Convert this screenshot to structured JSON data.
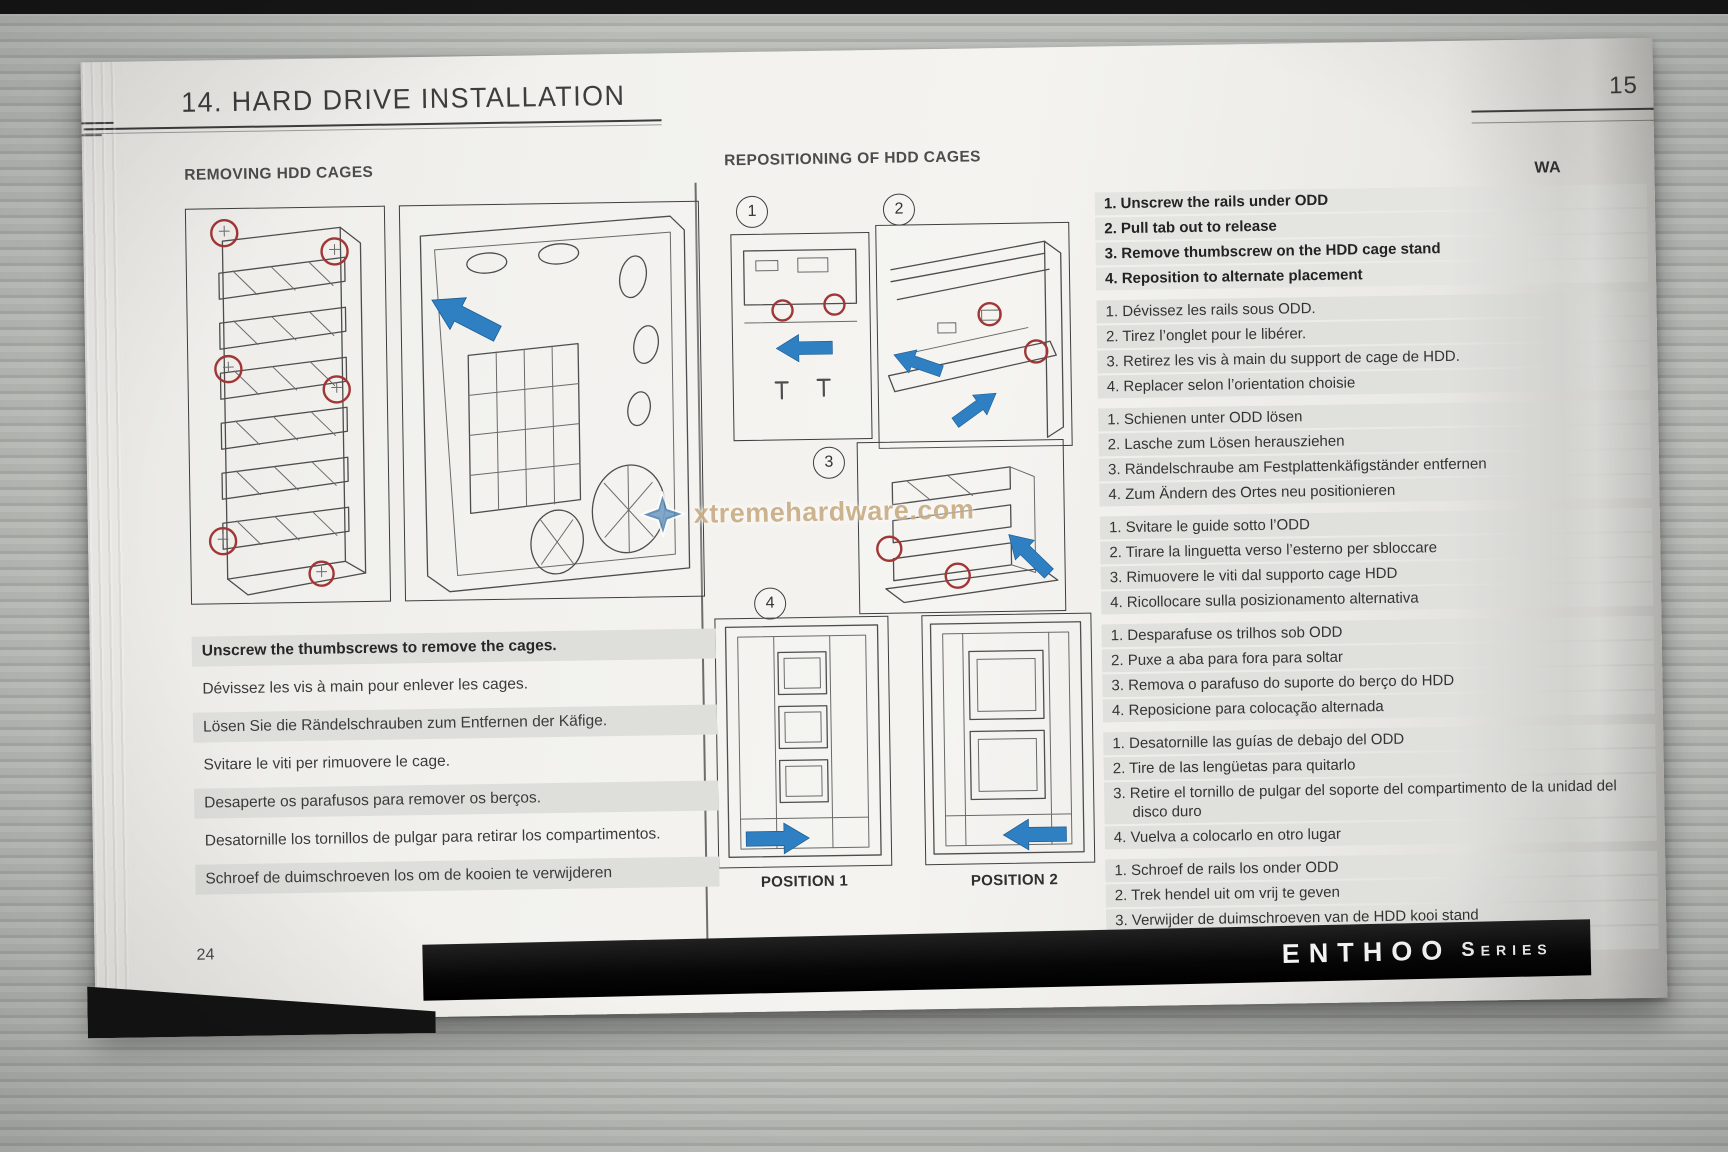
{
  "photo": {
    "background_color": "#b3b5b1",
    "accent_blue": "#2f80c3",
    "accent_red": "#a03636"
  },
  "header": {
    "title": "14. HARD DRIVE INSTALLATION",
    "next_page_number": "15",
    "next_page_partial_heading": "WA"
  },
  "watermark": {
    "text": "xtremehardware.com",
    "icon": "star-icon"
  },
  "removing": {
    "heading": "REMOVING HDD CAGES",
    "instructions": [
      {
        "lang": "en",
        "emphasis": true,
        "shaded": true,
        "text": "Unscrew the thumbscrews to remove the cages."
      },
      {
        "lang": "fr",
        "emphasis": false,
        "shaded": false,
        "text": "Dévissez les vis à main pour enlever les cages."
      },
      {
        "lang": "de",
        "emphasis": false,
        "shaded": true,
        "text": "Lösen Sie die Rändelschrauben zum Entfernen der Käfige."
      },
      {
        "lang": "it",
        "emphasis": false,
        "shaded": false,
        "text": "Svitare le viti per rimuovere le cage."
      },
      {
        "lang": "pt",
        "emphasis": false,
        "shaded": true,
        "text": "Desaperte os parafusos para remover os berços."
      },
      {
        "lang": "es",
        "emphasis": false,
        "shaded": false,
        "text": "Desatornille los tornillos de pulgar para retirar los compartimentos."
      },
      {
        "lang": "nl",
        "emphasis": false,
        "shaded": true,
        "text": "Schroef de duimschroeven los om de kooien te verwijderen"
      }
    ]
  },
  "repositioning": {
    "heading": "REPOSITIONING OF HDD CAGES",
    "step_badges": [
      "1",
      "2",
      "3",
      "4"
    ],
    "position_labels": [
      "POSITION 1",
      "POSITION 2"
    ],
    "languages": [
      {
        "lang": "en",
        "emphasis": true,
        "steps": [
          "1. Unscrew the rails under ODD",
          "2. Pull tab out to release",
          "3. Remove thumbscrew on the HDD cage stand",
          "4. Reposition to alternate placement"
        ]
      },
      {
        "lang": "fr",
        "emphasis": false,
        "steps": [
          "1. Dévissez les rails sous ODD.",
          "2. Tirez l’onglet pour le libérer.",
          "3. Retirez les vis à main du support de cage de HDD.",
          "4. Replacer selon l’orientation choisie"
        ]
      },
      {
        "lang": "de",
        "emphasis": false,
        "steps": [
          "1. Schienen unter ODD lösen",
          "2. Lasche zum Lösen herausziehen",
          "3. Rändelschraube am Festplattenkäfigständer entfernen",
          "4. Zum Ändern des Ortes neu positionieren"
        ]
      },
      {
        "lang": "it",
        "emphasis": false,
        "steps": [
          "1. Svitare le guide sotto l’ODD",
          "2. Tirare la linguetta verso l’esterno per sbloccare",
          "3. Rimuovere le viti dal supporto cage HDD",
          "4. Ricollocare sulla posizionamento alternativa"
        ]
      },
      {
        "lang": "pt",
        "emphasis": false,
        "steps": [
          "1. Desparafuse os trilhos sob ODD",
          "2. Puxe a aba para fora para soltar",
          "3. Remova o parafuso do suporte do berço do HDD",
          "4. Reposicione para colocação alternada"
        ]
      },
      {
        "lang": "es",
        "emphasis": false,
        "steps": [
          "1. Desatornille las guías de debajo del ODD",
          "2. Tire de las lengüetas para quitarlo",
          "3. Retire el tornillo de pulgar del soporte del compartimento de la unidad del disco duro",
          "4. Vuelva a colocarlo en otro lugar"
        ]
      },
      {
        "lang": "nl",
        "emphasis": false,
        "steps": [
          "1. Schroef de rails los onder ODD",
          "2. Trek hendel uit om vrij te geven",
          "3. Verwijder de duimschroeven van de HDD kooi stand",
          "4. Herpositoneer voor alternatieve plaasting"
        ]
      }
    ]
  },
  "footer": {
    "page_number": "24",
    "brand_primary": "ENTHOO",
    "brand_secondary": "Series"
  }
}
